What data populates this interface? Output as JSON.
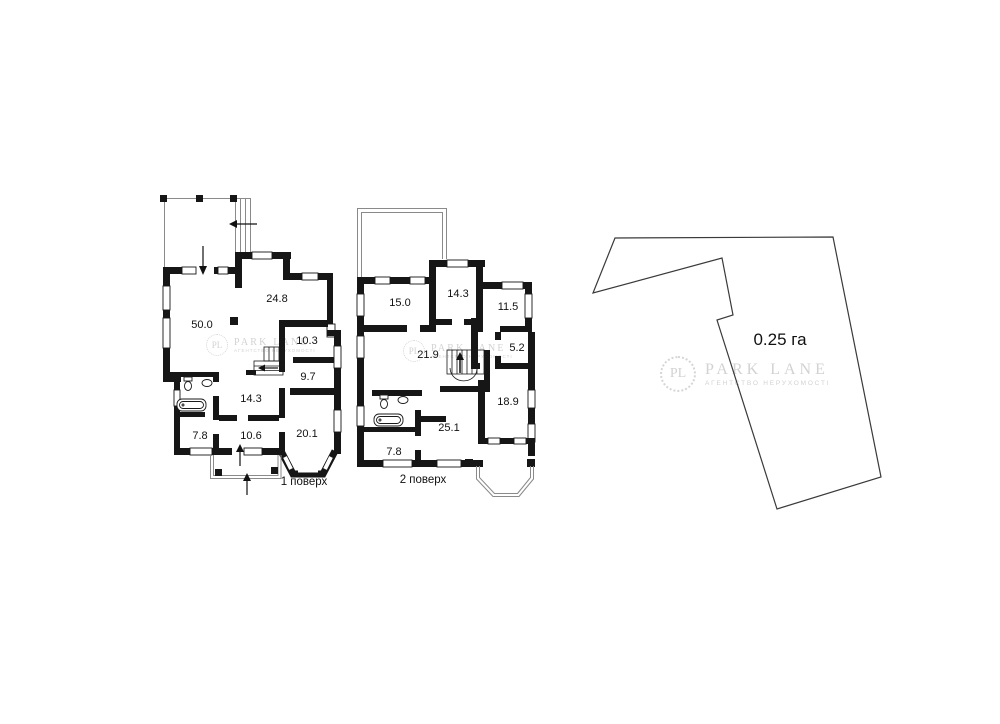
{
  "page": {
    "width": 1000,
    "height": 724,
    "background": "#ffffff"
  },
  "colors": {
    "wall": "#161616",
    "thin_line": "#8a8a8a",
    "plot_outline": "#3a3a3a",
    "label_text": "#111111",
    "watermark": "#d2d2d2"
  },
  "watermark": {
    "initials": "PL",
    "title": "PARK LANE",
    "subtitle": "АГЕНТСТВО НЕРУХОМОСТІ"
  },
  "floor1": {
    "caption": "1 поверх",
    "rooms": [
      "50.0",
      "24.8",
      "10.3",
      "9.7",
      "14.3",
      "7.8",
      "10.6",
      "20.1"
    ]
  },
  "floor2": {
    "caption": "2 поверх",
    "rooms": [
      "15.0",
      "14.3",
      "11.5",
      "21.9",
      "5.2",
      "18.9",
      "25.1",
      "7.8"
    ]
  },
  "plot": {
    "area_label": "0.25 га"
  }
}
